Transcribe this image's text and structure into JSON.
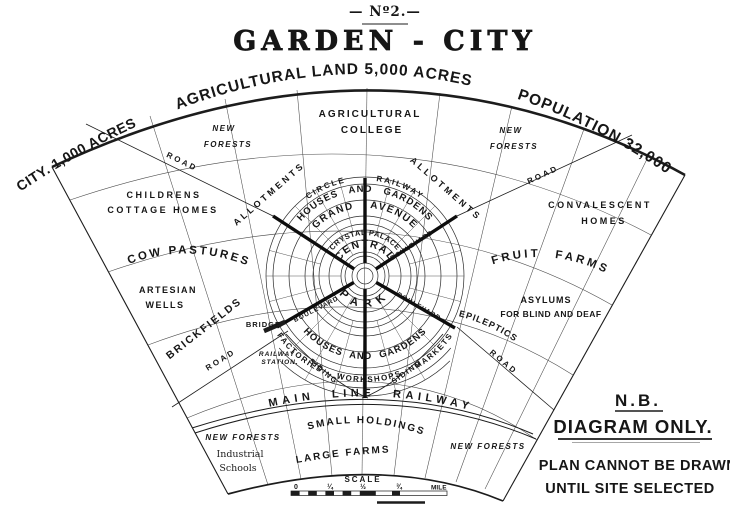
{
  "title": {
    "number": "— Nº2.—",
    "name": "GARDEN - CITY"
  },
  "arc": {
    "left": "CITY. 1,000 ACRES",
    "top": "AGRICULTURAL LAND 5,000 ACRES",
    "right": "POPULATION 32,000"
  },
  "city": {
    "circle_railway": "CIRCLE RAILWAY",
    "houses_gardens_top": "HOUSES AND GARDENS",
    "grand_avenue": "GRAND AVENUE",
    "crystal_palace": "CRYSTAL PALACE",
    "central": "CENTRAL",
    "park": "PARK",
    "houses_gardens_bottom": "HOUSES AND GARDENS",
    "factories": "FACTORIES WORKSHOPS MARKETS",
    "boulevard_ne": "BOULEVARD",
    "boulevard_se": "BOULEVARD",
    "boulevard_sw": "BOULEVARD",
    "allotments_left": "ALLOTMENTS",
    "allotments_right": "ALLOTMENTS",
    "siding_left": "SIDING",
    "siding_right": "SIDING",
    "bridge": "BRIDGE",
    "railway_station": [
      "RAILWAY",
      "STATION."
    ]
  },
  "land": {
    "new_forests_tl": [
      "NEW",
      "FORESTS"
    ],
    "new_forests_tr": [
      "NEW",
      "FORESTS"
    ],
    "new_forests_bl": "NEW FORESTS",
    "new_forests_br": "NEW FORESTS",
    "agricultural_college": [
      "AGRICULTURAL",
      "COLLEGE"
    ],
    "childrens_homes": [
      "CHILDRENS",
      "COTTAGE HOMES"
    ],
    "cow_pastures": "COW PASTURES",
    "artesian_wells": [
      "ARTESIAN",
      "WELLS"
    ],
    "brickfields": "BRICKFIELDS",
    "convalescent_homes": [
      "CONVALESCENT",
      "HOMES"
    ],
    "fruit_farms": "FRUIT FARMS",
    "asylums": [
      "ASYLUMS",
      "FOR BLIND AND DEAF"
    ],
    "epileptics": "FARM FOR EPILEPTICS",
    "industrial_schools": [
      "Industrial",
      "Schools"
    ],
    "large_farms": "LARGE FARMS",
    "small_holdings": "SMALL HOLDINGS"
  },
  "roads": {
    "nw": "ROAD",
    "ne": "ROAD",
    "sw": "ROAD",
    "se": "ROAD"
  },
  "railway": {
    "main_line": "MAIN LINE RAILWAY"
  },
  "note": {
    "nb": "N.B.",
    "diagram_only": "DIAGRAM ONLY.",
    "line2": "PLAN CANNOT BE DRAWN",
    "line3": "UNTIL SITE SELECTED"
  },
  "scale": {
    "label": "SCALE",
    "ticks": [
      "0",
      "¼",
      "½",
      "¾"
    ],
    "unit": "MILE"
  },
  "colors": {
    "ink": "#161616",
    "paper": "#ffffff"
  }
}
